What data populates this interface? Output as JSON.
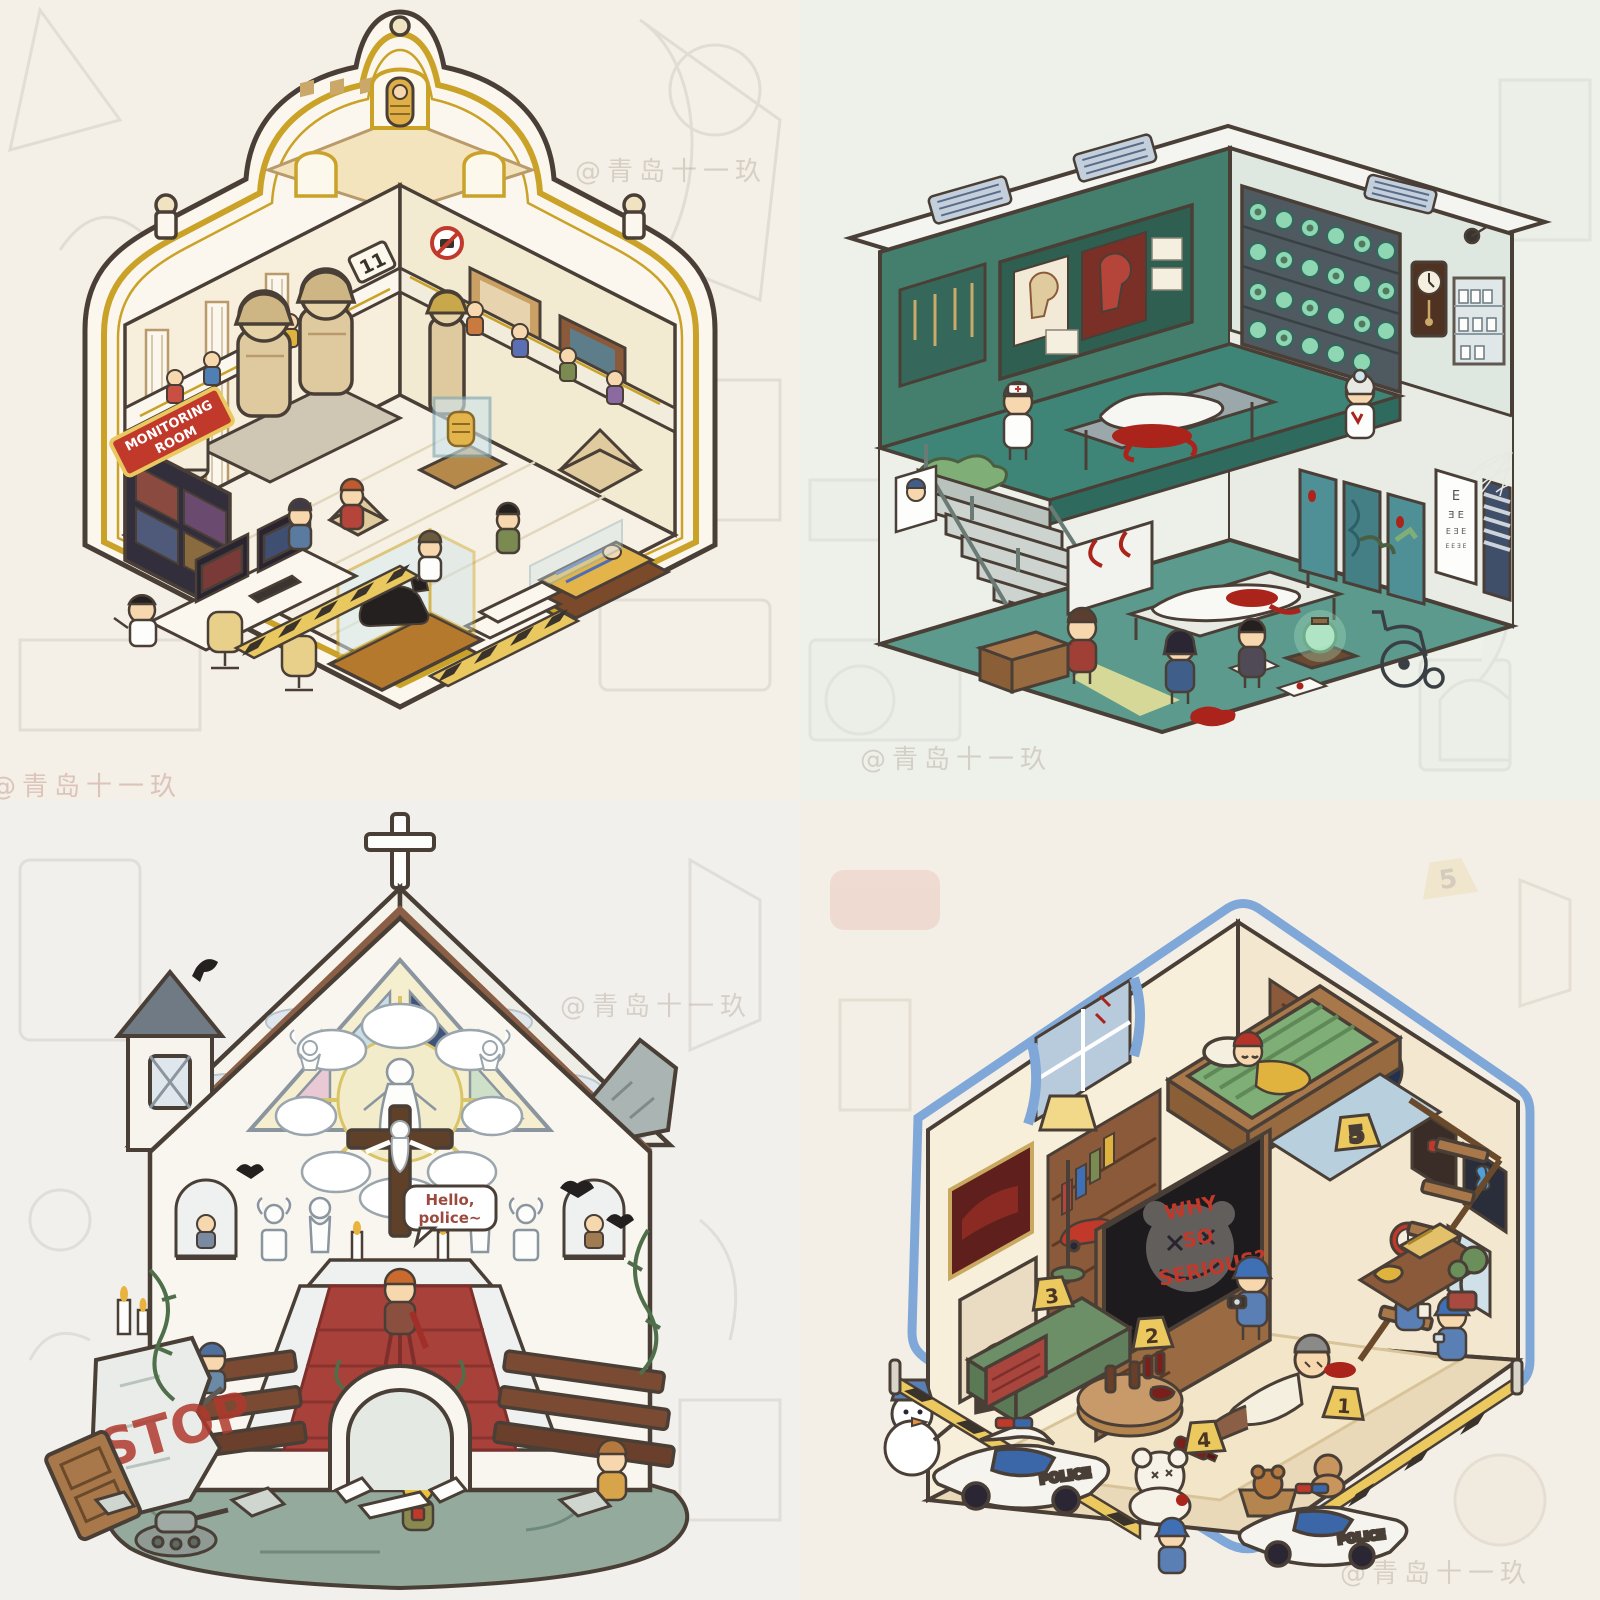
{
  "image": {
    "description": "2x2 collage of isometric cutaway hidden-object rooms",
    "artist_watermark": "@青岛十一玖"
  },
  "colors": {
    "background": "#f3efe8",
    "ink": "#4a3f36",
    "museum_gold": "#c9a227",
    "hospital_green_wall": "#447e6c",
    "hospital_floor": "#4f8d7e",
    "blood_red": "#aa241c",
    "church_carpet": "#a8413a",
    "church_rock": "#93aa9d",
    "room_cream": "#f8efda",
    "police_blue": "#3b66a8",
    "marker_yellow": "#ecc95f",
    "outline_blue": "#7fa8d9"
  },
  "panels": {
    "museum": {
      "name": "egyptian-museum-room",
      "plaque_number": "11",
      "monitoring_sign_lines": [
        "MONITORING",
        "ROOM"
      ]
    },
    "hospital": {
      "name": "haunted-hospital-room",
      "eye_chart_rows": [
        "E",
        "Ǝ E",
        "E Ǝ E",
        "E E Ǝ E"
      ]
    },
    "church": {
      "name": "church-crime-scene",
      "graffiti": "STOP",
      "speech_bubble_lines": [
        "Hello,",
        "police~"
      ],
      "exclamation": "!"
    },
    "detective": {
      "name": "detective-living-room",
      "tv_text_lines": [
        "WHY",
        "SO",
        "SERIOUS?"
      ],
      "police_car_label": "POLICE",
      "evidence_markers": [
        "1",
        "2",
        "3",
        "4",
        "5"
      ]
    }
  }
}
